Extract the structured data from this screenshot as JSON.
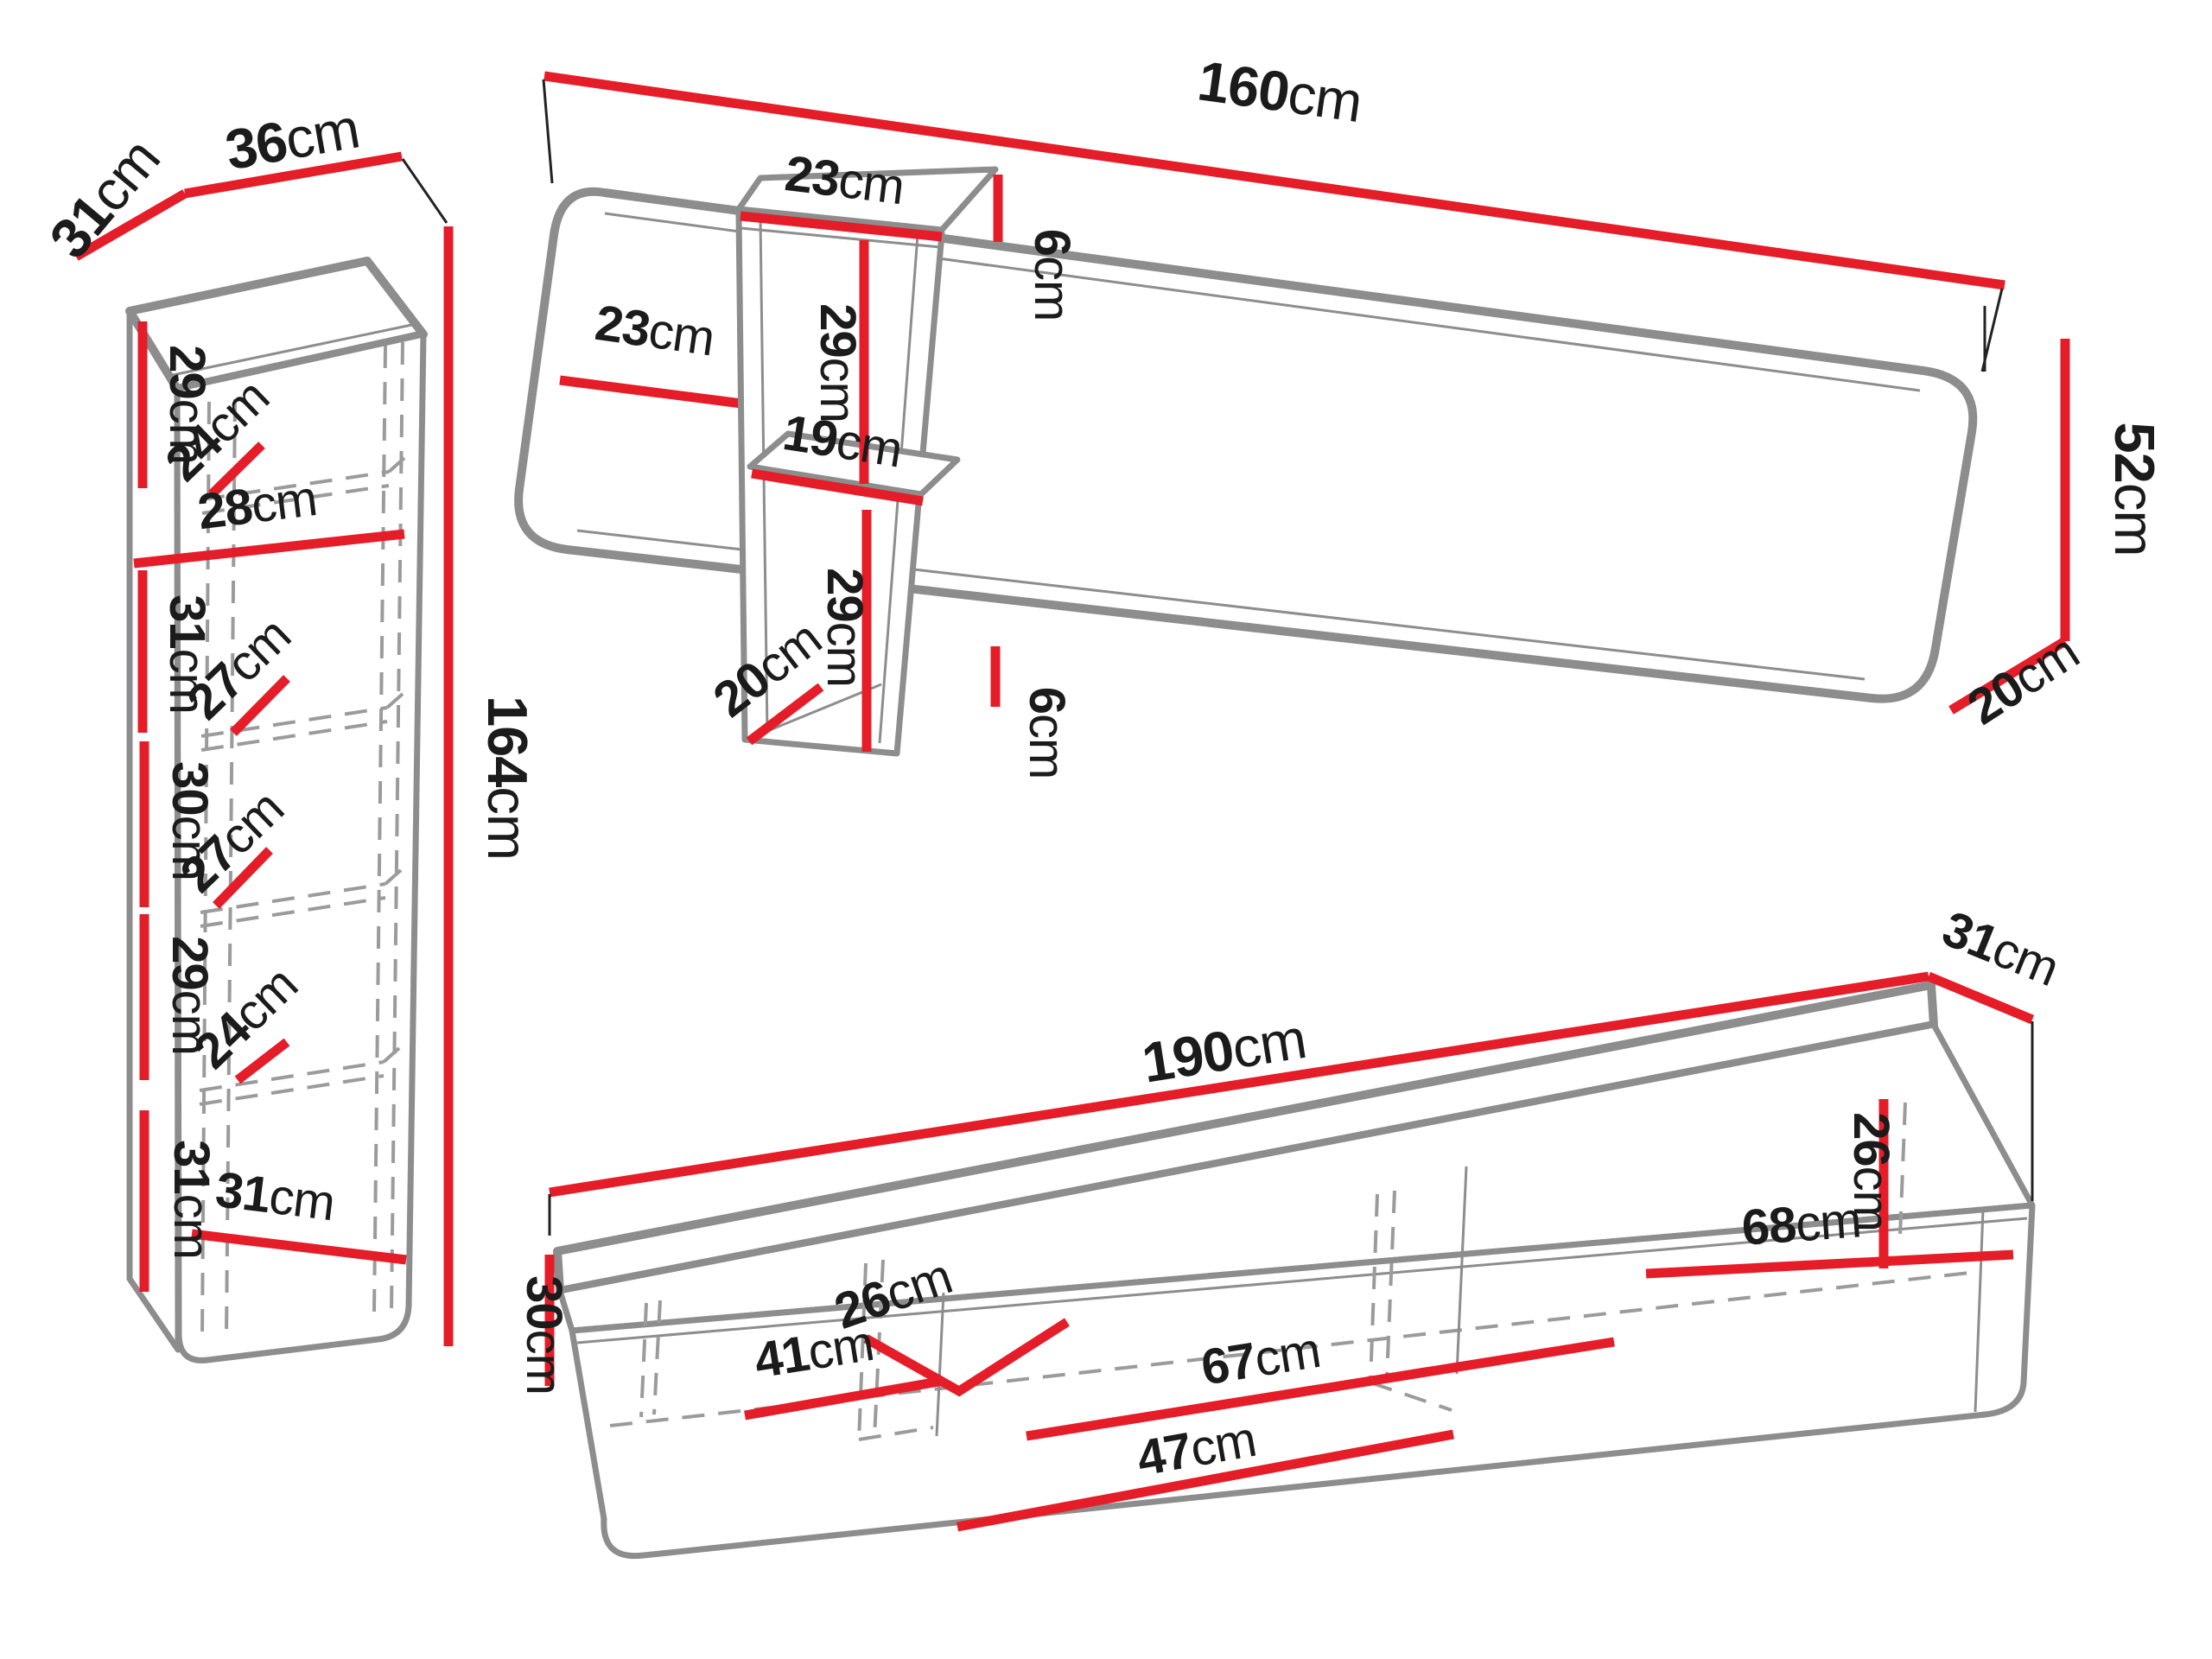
{
  "diagram": {
    "title": "furniture wall-unit dimension diagram",
    "units": "cm",
    "colors": {
      "dimension_line": "#e51d28",
      "outline": "#8d8d8d",
      "text": "#1b1b1b",
      "background": "#ffffff"
    },
    "pieces": [
      {
        "name": "tall-cabinet",
        "width": "36cm",
        "depth": "31cm",
        "height": "164cm",
        "compartment_heights": [
          "29cm",
          "31cm",
          "30cm",
          "29cm",
          "31cm"
        ],
        "compartment_depths": [
          "24cm",
          "27cm",
          "27cm",
          "24cm"
        ],
        "inner_width": "28cm",
        "bottom_inner_width": "31cm"
      },
      {
        "name": "wall-panel",
        "width": "160cm",
        "height": "52cm",
        "depth": "20cm",
        "left_offset_to_shelf": "23cm",
        "shelf_overhang_top": "6cm",
        "shelf_overhang_bottom": "6cm"
      },
      {
        "name": "hanging-shelf-unit",
        "top_width": "23cm",
        "bottom_depth": "20cm",
        "shelf_width": "19cm",
        "compartment_heights": [
          "29cm",
          "29cm"
        ]
      },
      {
        "name": "tv-stand",
        "width": "190cm",
        "depth": "31cm",
        "height": "30cm",
        "section_widths": [
          "41cm",
          "67cm",
          "68cm"
        ],
        "inner_height": "26cm",
        "inner_depth": "26cm",
        "lower_inner_width": "47cm"
      }
    ]
  },
  "labels": {
    "cabinet": {
      "depth": {
        "n": "31",
        "u": "cm"
      },
      "width": {
        "n": "36",
        "u": "cm"
      },
      "height": {
        "n": "164",
        "u": "cm"
      },
      "shelf1": {
        "n": "29",
        "u": "cm"
      },
      "depth1": {
        "n": "24",
        "u": "cm"
      },
      "inner_width": {
        "n": "28",
        "u": "cm"
      },
      "shelf2": {
        "n": "31",
        "u": "cm"
      },
      "depth2": {
        "n": "27",
        "u": "cm"
      },
      "shelf3": {
        "n": "30",
        "u": "cm"
      },
      "depth3": {
        "n": "27",
        "u": "cm"
      },
      "shelf4": {
        "n": "29",
        "u": "cm"
      },
      "depth4": {
        "n": "24",
        "u": "cm"
      },
      "shelf5": {
        "n": "31",
        "u": "cm"
      },
      "bottom_width": {
        "n": "31",
        "u": "cm"
      }
    },
    "panel": {
      "width": {
        "n": "160",
        "u": "cm"
      },
      "height": {
        "n": "52",
        "u": "cm"
      },
      "depth": {
        "n": "20",
        "u": "cm"
      },
      "left_offset": {
        "n": "23",
        "u": "cm"
      },
      "overhang_top": {
        "n": "6",
        "u": "cm"
      },
      "overhang_bottom": {
        "n": "6",
        "u": "cm"
      }
    },
    "shelf_unit": {
      "top_width": {
        "n": "23",
        "u": "cm"
      },
      "upper": {
        "n": "29",
        "u": "cm"
      },
      "shelf_width": {
        "n": "19",
        "u": "cm"
      },
      "lower": {
        "n": "29",
        "u": "cm"
      },
      "bottom_depth": {
        "n": "20",
        "u": "cm"
      }
    },
    "stand": {
      "width": {
        "n": "190",
        "u": "cm"
      },
      "depth": {
        "n": "31",
        "u": "cm"
      },
      "height": {
        "n": "30",
        "u": "cm"
      },
      "section1": {
        "n": "41",
        "u": "cm"
      },
      "inner_depth": {
        "n": "26",
        "u": "cm"
      },
      "section2": {
        "n": "67",
        "u": "cm"
      },
      "lower_width": {
        "n": "47",
        "u": "cm"
      },
      "section3": {
        "n": "68",
        "u": "cm"
      },
      "inner_height": {
        "n": "26",
        "u": "cm"
      }
    }
  }
}
